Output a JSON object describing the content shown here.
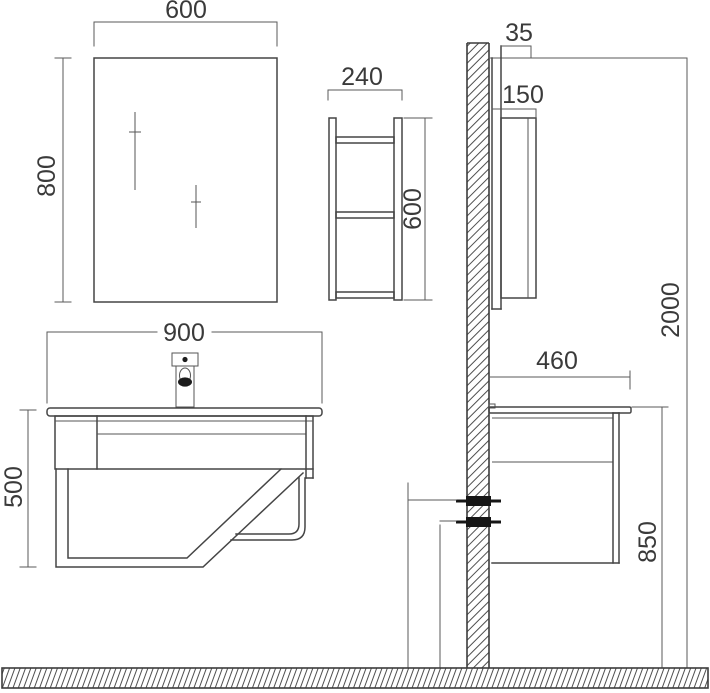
{
  "drawing": {
    "type": "technical-installation-diagram",
    "subject": "wall-mounted bathroom vanity set with mirror and shelf",
    "colors": {
      "line": "#454545",
      "dimension_line": "#5a5a5a",
      "text": "#3a3a3a",
      "bracket": "#161616",
      "background": "#ffffff"
    },
    "dims": {
      "mirror_width": "600",
      "mirror_height": "800",
      "shelf_width": "240",
      "shelf_height": "600",
      "vanity_width": "900",
      "vanity_height": "500",
      "mirror_depth": "35",
      "shelf_depth": "150",
      "wall_height": "2000",
      "counter_depth": "460",
      "counter_height": "850"
    }
  }
}
